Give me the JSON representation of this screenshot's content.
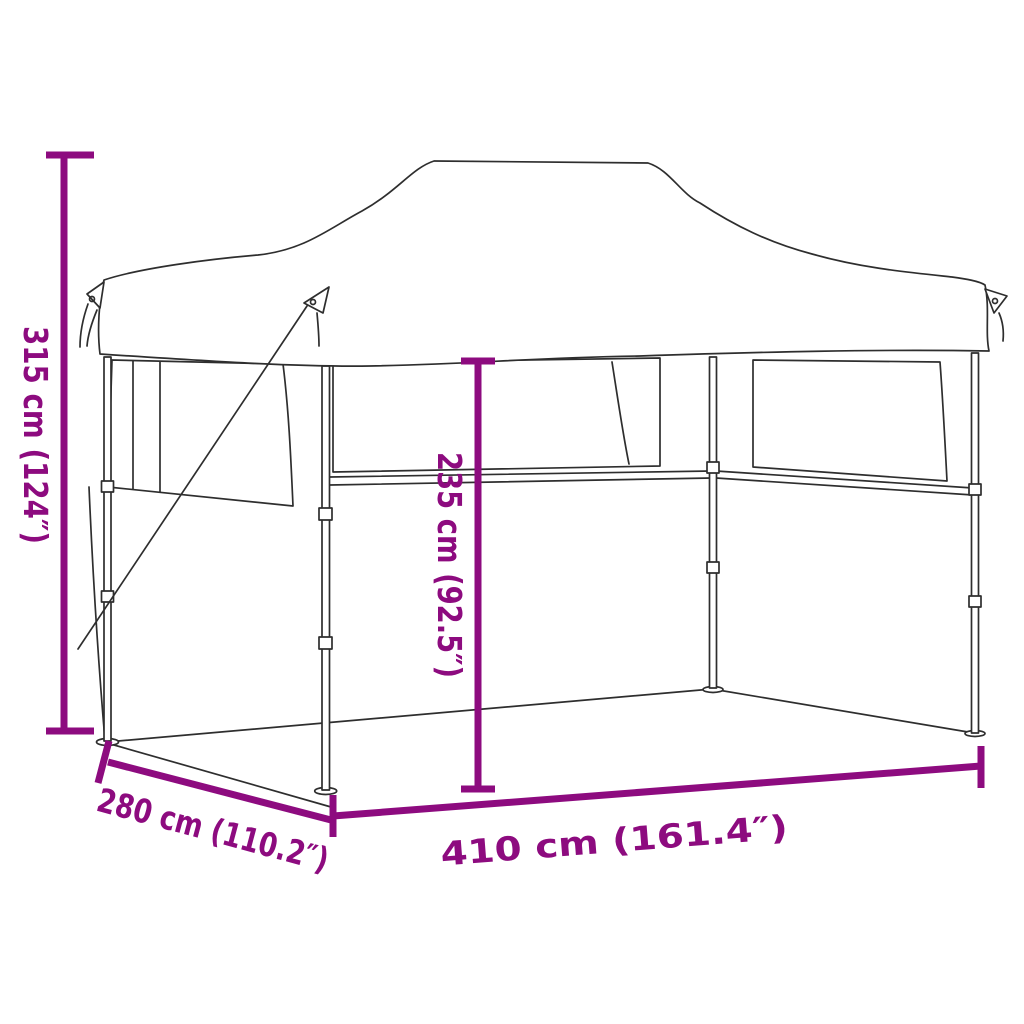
{
  "diagram": {
    "subject": "pop-up folding party tent with sidewalls — dimension line drawing",
    "background_color": "#ffffff",
    "line_art_color": "#2e2e2e",
    "annotation_color": "#8d0b7f",
    "dimensions": {
      "total_height": {
        "cm": "315",
        "inches": "124",
        "label": "315 cm (124″)"
      },
      "wall_height": {
        "cm": "235",
        "inches": "92.5",
        "label": "235 cm (92.5″)"
      },
      "length": {
        "cm": "410",
        "inches": "161.4",
        "label": "410 cm (161.4″)"
      },
      "depth": {
        "cm": "280",
        "inches": "110.2",
        "label": "280 cm (110.2″)"
      }
    }
  }
}
